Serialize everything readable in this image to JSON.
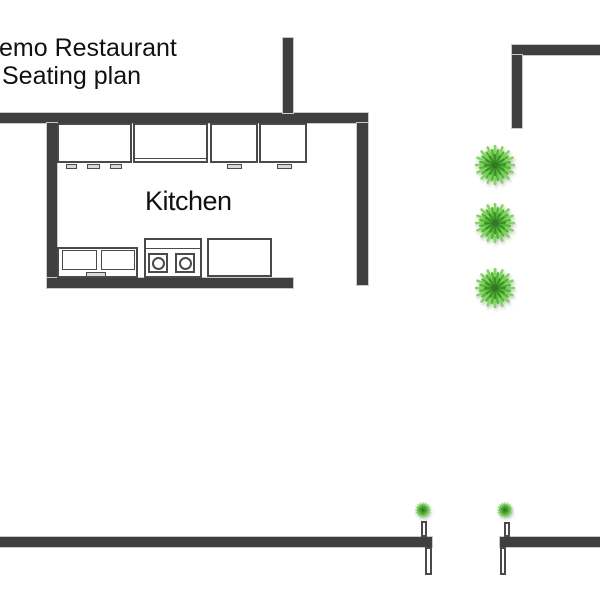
{
  "title": {
    "line1": "emo Restaurant",
    "line2": "Seating plan"
  },
  "kitchen": {
    "label": "Kitchen"
  },
  "plants": {
    "large_count": 3,
    "small_count": 2
  },
  "colors": {
    "wall": "#3f3f3f",
    "wall_edge": "#c9c9c9",
    "outline": "#4a4a4a",
    "handle": "#d9d9d9",
    "plant_light": "#7ed957",
    "plant_mid": "#56b43c",
    "plant_dark": "#3c8f28",
    "plant_core": "#2f7d20",
    "text": "#111111"
  }
}
